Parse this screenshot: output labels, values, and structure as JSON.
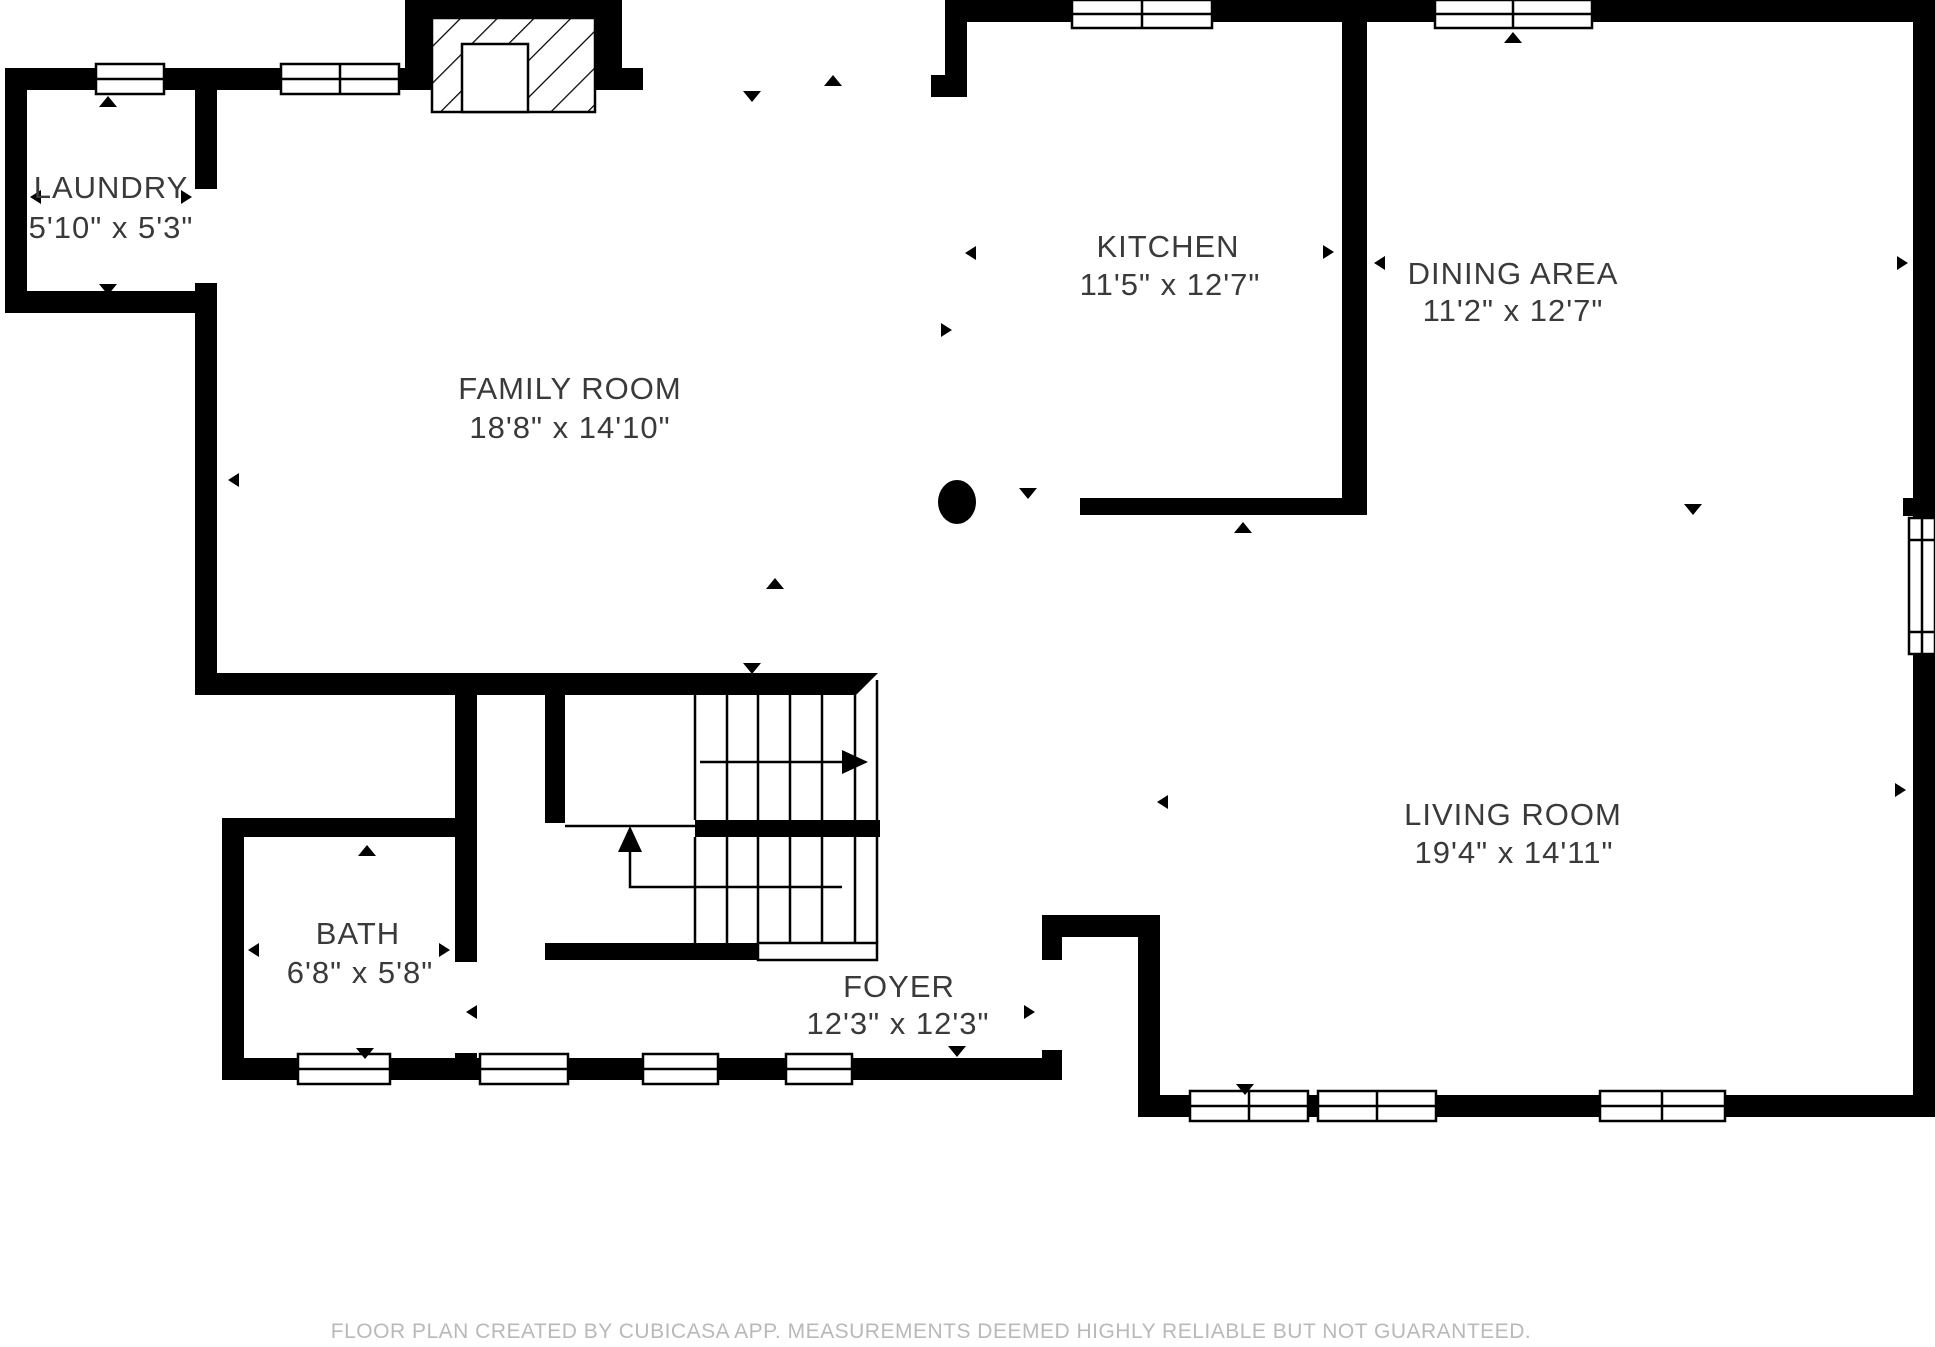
{
  "page": {
    "background": "#ffffff"
  },
  "colors": {
    "wall": "#000000",
    "label_text": "#3a3a3a",
    "footer_text": "#b9b9b9"
  },
  "rooms": [
    {
      "id": "laundry",
      "name": "LAUNDRY",
      "dimensions": "5'10\" x 5'3\""
    },
    {
      "id": "family-room",
      "name": "FAMILY ROOM",
      "dimensions": "18'8\" x 14'10\""
    },
    {
      "id": "kitchen",
      "name": "KITCHEN",
      "dimensions": "11'5\" x 12'7\""
    },
    {
      "id": "dining-area",
      "name": "DINING AREA",
      "dimensions": "11'2\" x 12'7\""
    },
    {
      "id": "bath",
      "name": "BATH",
      "dimensions": "6'8\" x 5'8\""
    },
    {
      "id": "foyer",
      "name": "FOYER",
      "dimensions": "12'3\" x 12'3\""
    },
    {
      "id": "living-room",
      "name": "LIVING ROOM",
      "dimensions": "19'4\" x 14'11\""
    }
  ],
  "footer": {
    "disclaimer": "FLOOR PLAN CREATED BY CUBICASA APP. MEASUREMENTS DEEMED HIGHLY RELIABLE BUT NOT GUARANTEED."
  }
}
